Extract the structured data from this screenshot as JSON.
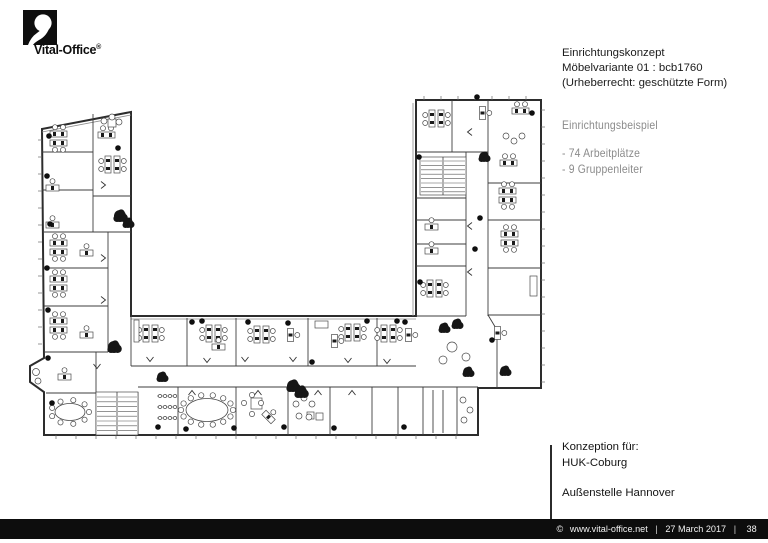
{
  "logo": {
    "brand": "Vital-Office",
    "registered_mark": "®"
  },
  "title_block": {
    "lines": [
      "Einrichtungskonzept",
      "Möbelvariante 01 : bcb1760",
      "(Urheberrecht: geschützte Form)"
    ]
  },
  "info_block": {
    "heading": "Einrichtungsbeispiel",
    "items": [
      "- 74 Arbeitplätze",
      "- 9 Gruppenleiter"
    ]
  },
  "client_block": {
    "intro": "Konzeption für:",
    "client": "HUK-Coburg",
    "location": "Außenstelle Hannover"
  },
  "footer": {
    "copyright": "©",
    "website": "www.vital-office.net",
    "divider": "|",
    "date": "27 March 2017",
    "page_number": "38"
  },
  "colors": {
    "footer_bar": "#0d0d0d",
    "gray_text": "#8b8b8b",
    "plan_line": "#3d3d3d"
  }
}
